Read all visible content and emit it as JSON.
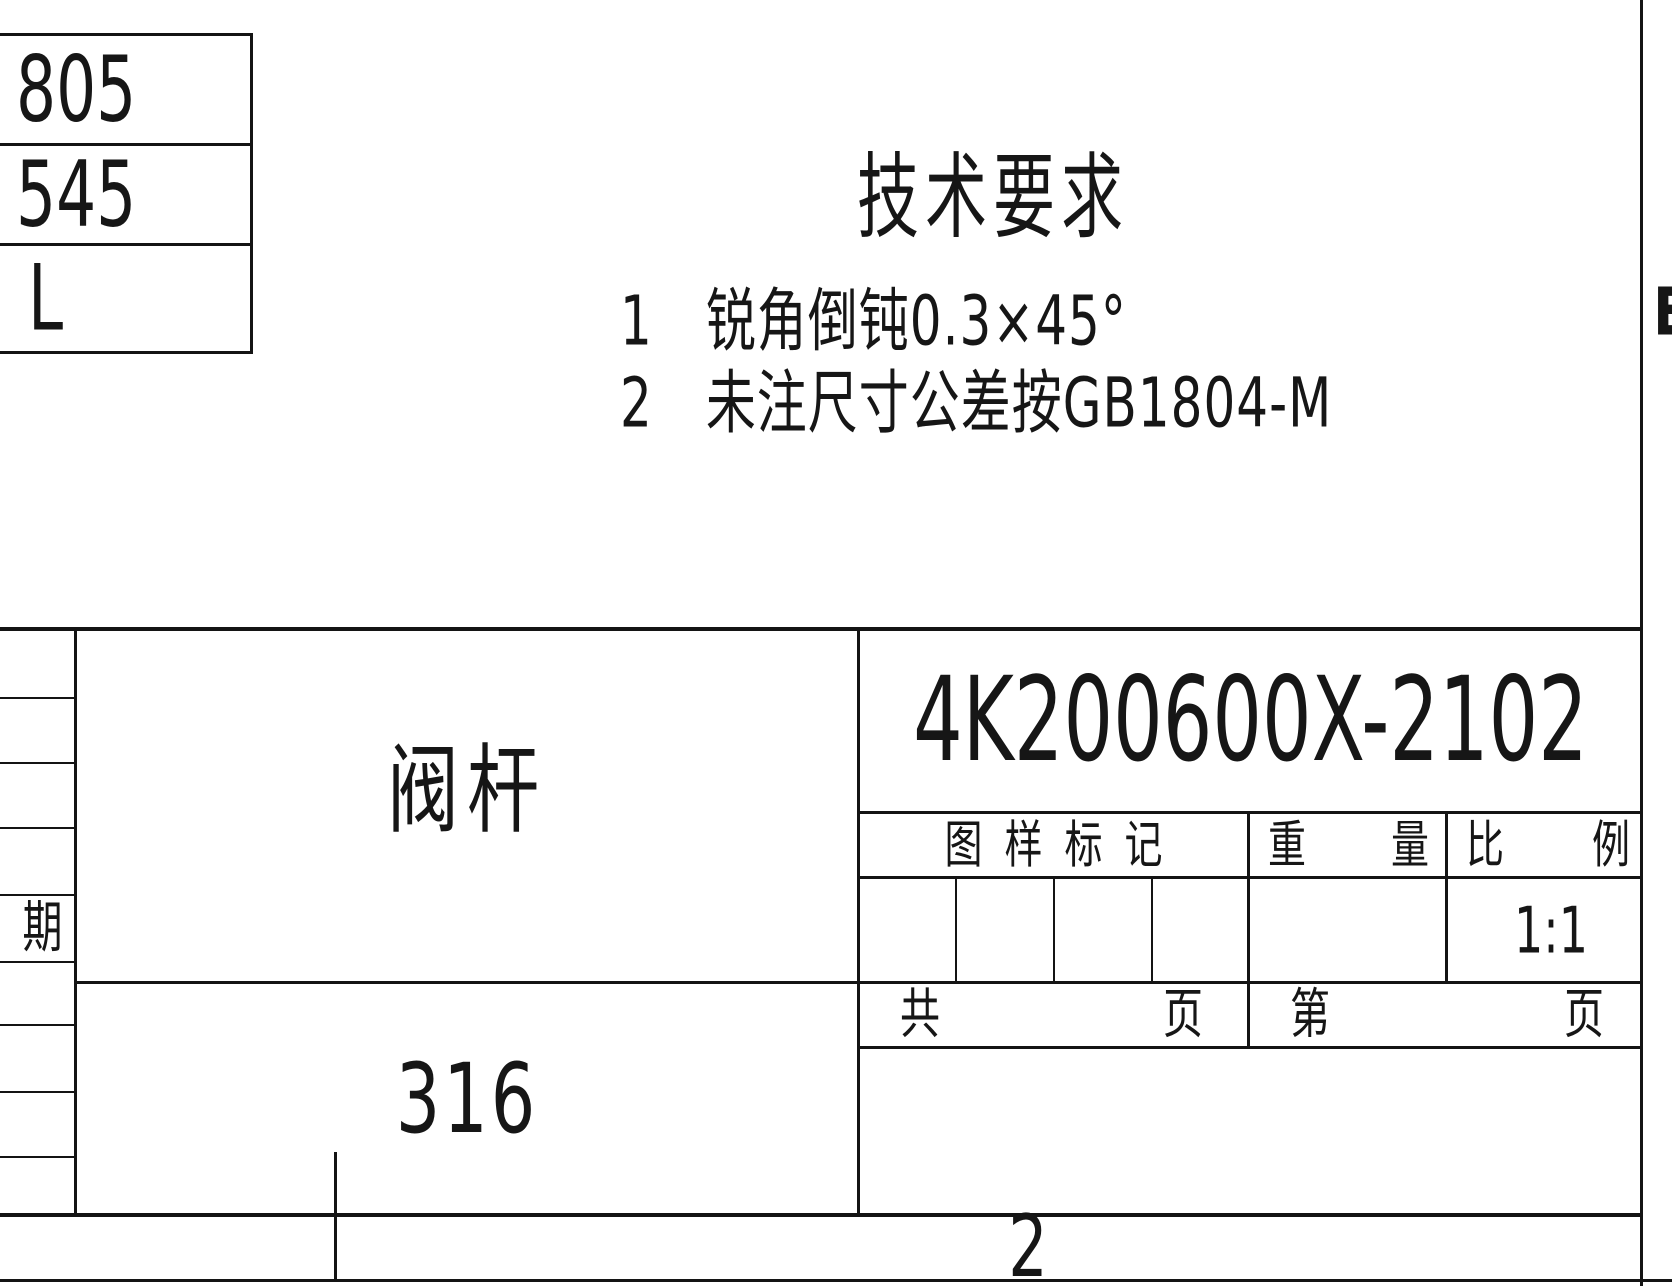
{
  "sheet": {
    "dimension_table": {
      "rows": [
        "805",
        "545",
        "L"
      ]
    },
    "technical_requirements": {
      "title": "技术要求",
      "items": [
        {
          "num": "1",
          "text": "锐角倒钝0.3×45°"
        },
        {
          "num": "2",
          "text": "未注尺寸公差按GB1804-M"
        }
      ]
    },
    "title_block": {
      "part_name": "阀杆",
      "drawing_number": "4K200600X-2102",
      "material": "316",
      "mark_header": "图样标记",
      "weight_header": {
        "left": "重",
        "right": "量"
      },
      "scale_header": {
        "left": "比",
        "right": "例"
      },
      "scale_value": "1:1",
      "total_pages": {
        "left": "共",
        "right": "页"
      },
      "page_number": {
        "left": "第",
        "right": "页"
      },
      "date_label": "期"
    },
    "zone_labels": {
      "right": "E",
      "bottom": "2"
    },
    "colors": {
      "line": "#141414",
      "text": "#161616",
      "background": "#ffffff"
    }
  }
}
